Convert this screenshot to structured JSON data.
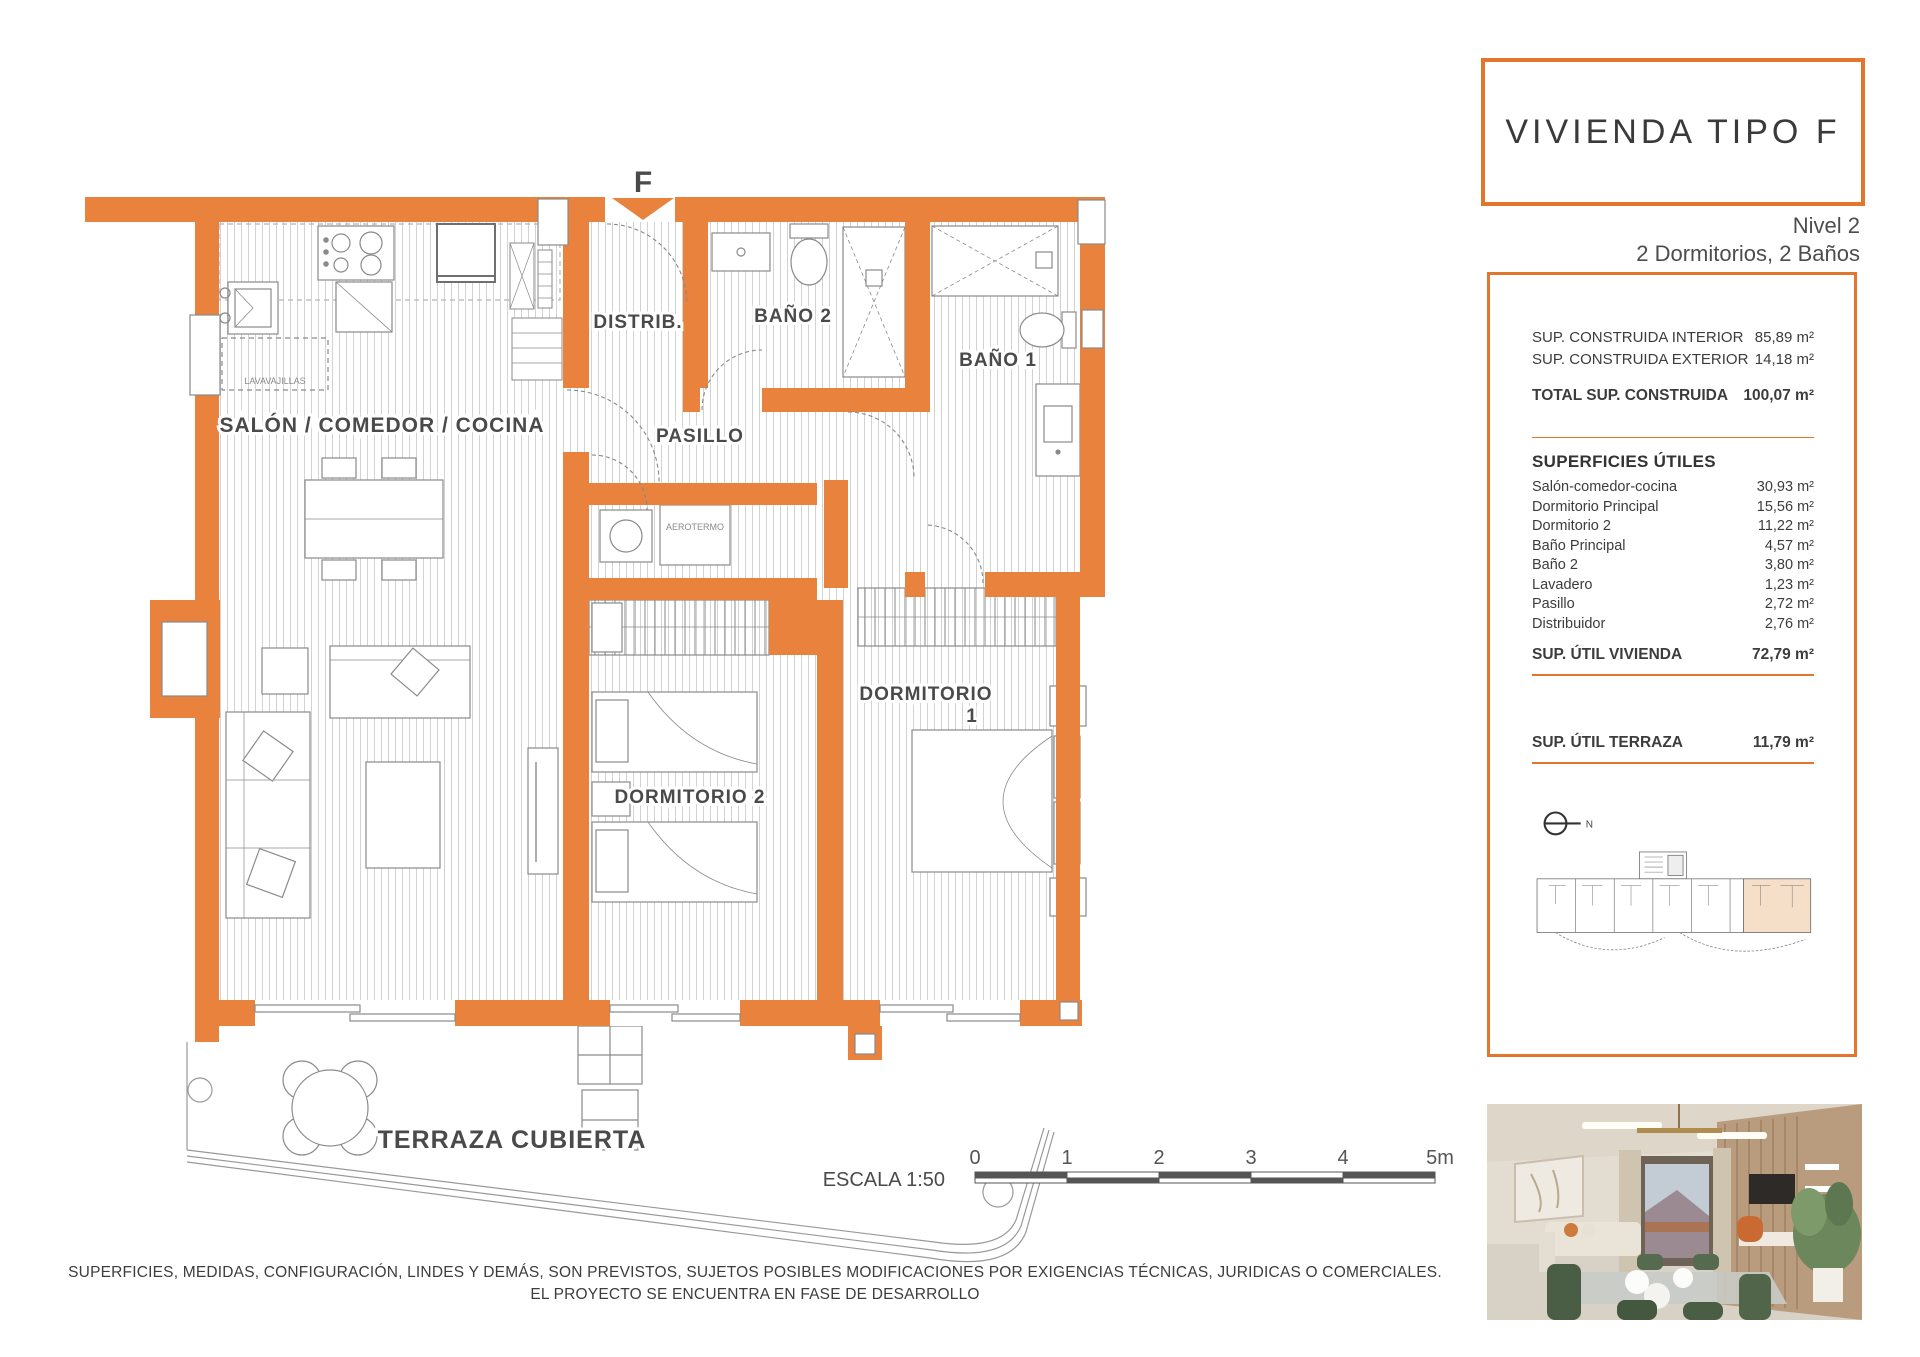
{
  "header": {
    "title": "VIVIENDA TIPO F",
    "level": "Nivel 2",
    "config": "2 Dormitorios, 2 Baños"
  },
  "panel": {
    "built": {
      "rows": [
        {
          "label": "SUP. CONSTRUIDA INTERIOR",
          "value": "85,89 m²"
        },
        {
          "label": "SUP. CONSTRUIDA EXTERIOR",
          "value": "14,18 m²"
        }
      ],
      "total": {
        "label": "TOTAL SUP. CONSTRUIDA",
        "value": "100,07 m²"
      }
    },
    "useful": {
      "heading": "SUPERFICIES ÚTILES",
      "rows": [
        {
          "label": "Salón-comedor-cocina",
          "value": "30,93 m²"
        },
        {
          "label": "Dormitorio Principal",
          "value": "15,56 m²"
        },
        {
          "label": "Dormitorio 2",
          "value": "11,22 m²"
        },
        {
          "label": "Baño Principal",
          "value": "4,57 m²"
        },
        {
          "label": "Baño 2",
          "value": "3,80 m²"
        },
        {
          "label": "Lavadero",
          "value": "1,23 m²"
        },
        {
          "label": "Pasillo",
          "value": "2,72 m²"
        },
        {
          "label": "Distribuidor",
          "value": "2,76 m²"
        }
      ],
      "total": {
        "label": "SUP. ÚTIL VIVIENDA",
        "value": "72,79 m²"
      }
    },
    "terrace": {
      "label": "SUP. ÚTIL TERRAZA",
      "value": "11,79 m²"
    },
    "north_label": "N"
  },
  "plan": {
    "entrance_marker": "F",
    "rooms": {
      "salon": "SALÓN / COMEDOR / COCINA",
      "distrib": "DISTRIB.",
      "bano2": "BAÑO 2",
      "bano1": "BAÑO 1",
      "pasillo": "PASILLO",
      "dorm2": "DORMITORIO 2",
      "dorm1_line1": "DORMITORIO",
      "dorm1_line2": "1",
      "terraza": "TERRAZA CUBIERTA"
    },
    "appliances": {
      "aerotermo": "AEROTERMO",
      "lavavajillas": "LAVAVAJILLAS"
    },
    "scale": {
      "label": "ESCALA 1:50",
      "ticks": [
        "0",
        "1",
        "2",
        "3",
        "4",
        "5m"
      ]
    }
  },
  "disclaimer": {
    "line1": "SUPERFICIES, MEDIDAS, CONFIGURACIÓN, LINDES Y DEMÁS, SON PREVISTOS, SUJETOS POSIBLES MODIFICACIONES POR EXIGENCIAS TÉCNICAS, JURIDICAS O COMERCIALES.",
    "line2": "EL PROYECTO SE ENCUENTRA EN FASE DE DESARROLLO"
  },
  "colors": {
    "wall_orange": "#E8823C",
    "accent_orange": "#E2762D",
    "unit_highlight": "#F6DFC9",
    "text_gray": "#4A4A4A"
  }
}
